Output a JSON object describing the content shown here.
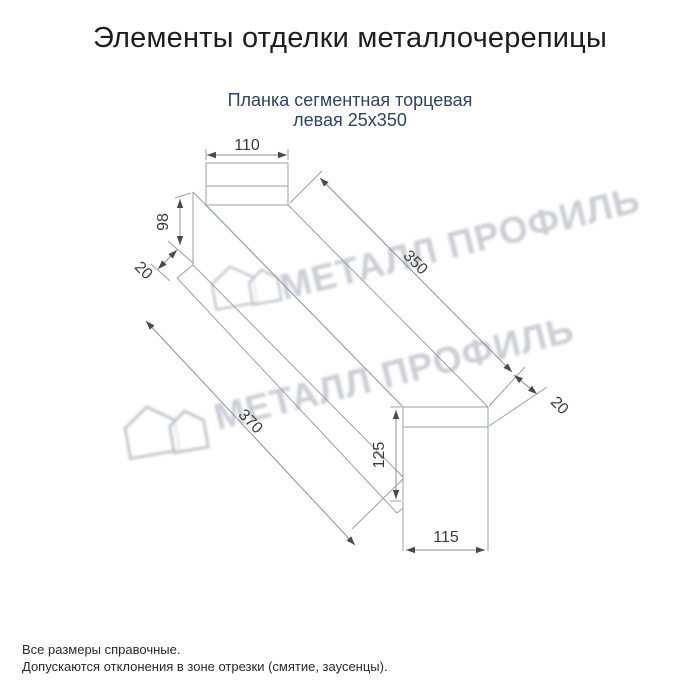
{
  "title": "Элементы отделки металлочерепицы",
  "subtitle": {
    "line1": "Планка сегментная торцевая",
    "line2": "левая 25х350"
  },
  "drawing": {
    "dims": {
      "top_width": "110",
      "left_height": "98",
      "left_fold": "20",
      "length_top": "350",
      "length_bottom": "370",
      "right_fold": "20",
      "end_height": "125",
      "end_width": "115"
    }
  },
  "watermark": {
    "text": "МЕТАЛЛ ПРОФИЛЬ"
  },
  "footnotes": {
    "line1": "Все размеры справочные.",
    "line2": "Допускаются отклонения в зоне отрезки (смятие, заусенцы)."
  }
}
